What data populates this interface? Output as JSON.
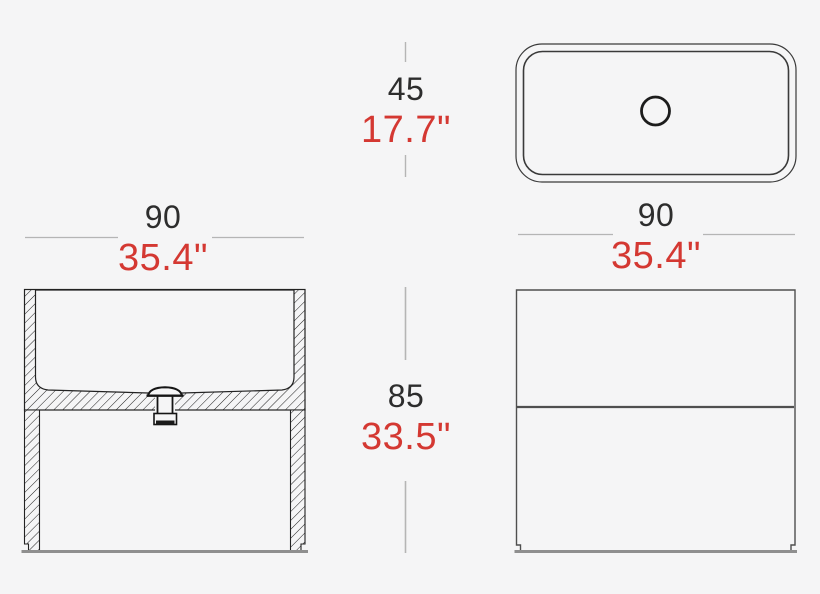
{
  "page": {
    "background": "#f5f5f6"
  },
  "colors": {
    "cm_text": "#2d2d2d",
    "inch_text": "#d43832",
    "dimension_line": "#b5b5b5",
    "drawing_dark": "#222222",
    "drawing_gray": "#4f4f4f",
    "base_line_gray": "#8f8f8f"
  },
  "dimensions": {
    "basin_depth": {
      "cm": "45",
      "inches": "17.7\""
    },
    "front_width": {
      "cm": "90",
      "inches": "35.4\""
    },
    "top_width": {
      "cm": "90",
      "inches": "35.4\""
    },
    "total_height": {
      "cm": "85",
      "inches": "33.5\""
    }
  }
}
